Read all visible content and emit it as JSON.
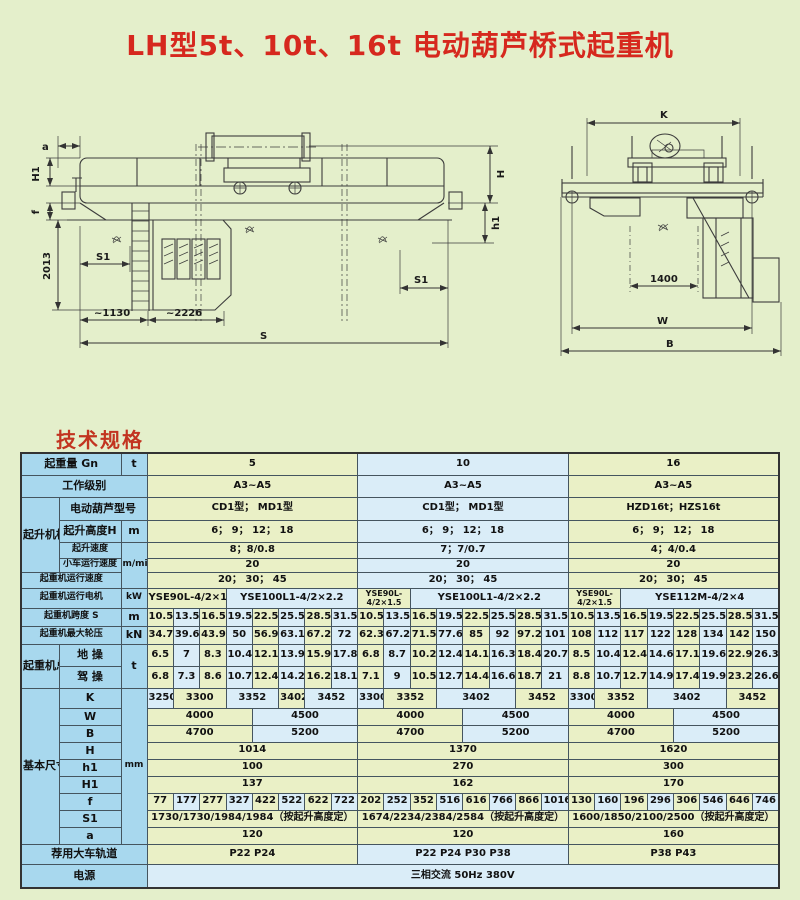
{
  "page": {
    "title": "LH型5t、10t、16t 电动葫芦桥式起重机",
    "section_heading": "技术规格",
    "bg_color": "#e4efcb",
    "title_color": "#d6281e",
    "label_cell_color": "#a8d8ee",
    "green_cell_color": "#eaf0c6",
    "blue_cell_color": "#daedf8"
  },
  "drawing": {
    "side_view": {
      "a": "a",
      "H1": "H1",
      "f": "f",
      "height_2013": "2013",
      "S1_left": "S1",
      "approx_1130": "~1130",
      "approx_2226": "~2226",
      "S": "S",
      "H": "H",
      "h1": "h1",
      "S1_right": "S1"
    },
    "end_view": {
      "K": "K",
      "gauge_1400": "1400",
      "W": "W",
      "B": "B"
    }
  },
  "table": {
    "left": {
      "capacity": "起重量 Gn",
      "capacity_unit": "t",
      "duty": "工作级别",
      "hoist_group": "起升机构",
      "hoist_model": "电动葫芦型号",
      "lift_height": "起升高度H",
      "lift_height_unit": "m",
      "lift_speed": "起升速度",
      "trolley_speed": "小车运行速度",
      "speed_unit": "m/min",
      "crane_speed": "起重机运行速度",
      "crane_motor": "起重机运行电机",
      "motor_unit": "kW",
      "span": "起重机跨度 S",
      "span_unit": "m",
      "wheel_load": "起重机最大轮压",
      "wheel_unit": "kN",
      "weight_group": "起重机总重",
      "ground_op": "地 操",
      "cab_op": "驾 操",
      "weight_unit": "t",
      "dims_group": "基本尺寸",
      "dims_unit": "mm",
      "dim_rows": [
        "K",
        "W",
        "B",
        "H",
        "h1",
        "H1",
        "f",
        "S1",
        "a"
      ],
      "rail": "荐用大车轨道",
      "power": "电源"
    },
    "power_value": "三相交流    50Hz    380V",
    "sections": [
      {
        "capacity": "5",
        "duty": "A3~A5",
        "hoist_model": "CD1型；  MD1型",
        "lift_height": "6；  9；  12；  18",
        "lift_speed": "8；8/0.8",
        "trolley_speed": "20",
        "crane_speed": "20；  30；  45",
        "motors": [
          {
            "text": "YSE90L-4/2×1.5",
            "span": 3
          },
          {
            "text": "YSE100L1-4/2×2.2",
            "span": 5
          }
        ],
        "spans": [
          "10.5",
          "13.5",
          "16.5",
          "19.5",
          "22.5",
          "25.5",
          "28.5",
          "31.5"
        ],
        "wheel_loads": [
          "34.7",
          "39.6",
          "43.9",
          "50",
          "56.9",
          "63.1",
          "67.2",
          "72"
        ],
        "ground": [
          "6.5",
          "7",
          "8.3",
          "10.4",
          "12.1",
          "13.9",
          "15.9",
          "17.8"
        ],
        "cab": [
          "6.8",
          "7.3",
          "8.6",
          "10.7",
          "12.4",
          "14.2",
          "16.2",
          "18.1"
        ],
        "K": [
          {
            "text": "3250",
            "span": 1
          },
          {
            "text": "3300",
            "span": 2
          },
          {
            "text": "3352",
            "span": 2
          },
          {
            "text": "3402",
            "span": 1
          },
          {
            "text": "3452",
            "span": 2
          }
        ],
        "W": [
          {
            "text": "4000",
            "span": 4
          },
          {
            "text": "4500",
            "span": 4
          }
        ],
        "B": [
          {
            "text": "4700",
            "span": 4
          },
          {
            "text": "5200",
            "span": 4
          }
        ],
        "H": "1014",
        "h1": "100",
        "H1": "137",
        "f": [
          "77",
          "177",
          "277",
          "327",
          "422",
          "522",
          "622",
          "722"
        ],
        "S1": "1730/1730/1984/1984（按起升高度定）",
        "a": "120",
        "rail": "P22    P24"
      },
      {
        "capacity": "10",
        "duty": "A3~A5",
        "hoist_model": "CD1型；  MD1型",
        "lift_height": "6；  9；  12；  18",
        "lift_speed": "7；7/0.7",
        "trolley_speed": "20",
        "crane_speed": "20；  30；  45",
        "motors": [
          {
            "text": "YSE90L-4/2×1.5",
            "span": 2,
            "small": true
          },
          {
            "text": "YSE100L1-4/2×2.2",
            "span": 6
          }
        ],
        "spans": [
          "10.5",
          "13.5",
          "16.5",
          "19.5",
          "22.5",
          "25.5",
          "28.5",
          "31.5"
        ],
        "wheel_loads": [
          "62.3",
          "67.2",
          "71.5",
          "77.6",
          "85",
          "92",
          "97.2",
          "101"
        ],
        "ground": [
          "6.8",
          "8.7",
          "10.2",
          "12.4",
          "14.1",
          "16.3",
          "18.4",
          "20.7"
        ],
        "cab": [
          "7.1",
          "9",
          "10.5",
          "12.7",
          "14.4",
          "16.6",
          "18.7",
          "21"
        ],
        "K": [
          {
            "text": "3300",
            "span": 1
          },
          {
            "text": "3352",
            "span": 2
          },
          {
            "text": "3402",
            "span": 3
          },
          {
            "text": "3452",
            "span": 2
          }
        ],
        "W": [
          {
            "text": "4000",
            "span": 4
          },
          {
            "text": "4500",
            "span": 4
          }
        ],
        "B": [
          {
            "text": "4700",
            "span": 4
          },
          {
            "text": "5200",
            "span": 4
          }
        ],
        "H": "1370",
        "h1": "270",
        "H1": "162",
        "f": [
          "202",
          "252",
          "352",
          "516",
          "616",
          "766",
          "866",
          "1016"
        ],
        "S1": "1674/2234/2384/2584（按起升高度定）",
        "a": "120",
        "rail": "P22   P24   P30   P38"
      },
      {
        "capacity": "16",
        "duty": "A3~A5",
        "hoist_model": "HZD16t；HZS16t",
        "lift_height": "6；  9；  12；  18",
        "lift_speed": "4；4/0.4",
        "trolley_speed": "20",
        "crane_speed": "20；  30；  45",
        "motors": [
          {
            "text": "YSE90L-4/2×1.5",
            "span": 2,
            "small": true
          },
          {
            "text": "YSE112M-4/2×4",
            "span": 6
          }
        ],
        "spans": [
          "10.5",
          "13.5",
          "16.5",
          "19.5",
          "22.5",
          "25.5",
          "28.5",
          "31.5"
        ],
        "wheel_loads": [
          "108",
          "112",
          "117",
          "122",
          "128",
          "134",
          "142",
          "150"
        ],
        "ground": [
          "8.5",
          "10.4",
          "12.4",
          "14.6",
          "17.1",
          "19.6",
          "22.9",
          "26.3"
        ],
        "cab": [
          "8.8",
          "10.7",
          "12.7",
          "14.9",
          "17.4",
          "19.9",
          "23.2",
          "26.6"
        ],
        "K": [
          {
            "text": "3300",
            "span": 1
          },
          {
            "text": "3352",
            "span": 2
          },
          {
            "text": "3402",
            "span": 3
          },
          {
            "text": "3452",
            "span": 2
          }
        ],
        "W": [
          {
            "text": "4000",
            "span": 4
          },
          {
            "text": "4500",
            "span": 4
          }
        ],
        "B": [
          {
            "text": "4700",
            "span": 4
          },
          {
            "text": "5200",
            "span": 4
          }
        ],
        "H": "1620",
        "h1": "300",
        "H1": "170",
        "f": [
          "130",
          "160",
          "196",
          "296",
          "306",
          "546",
          "646",
          "746"
        ],
        "S1": "1600/1850/2100/2500（按起升高度定）",
        "a": "160",
        "rail": "P38    P43"
      }
    ]
  }
}
